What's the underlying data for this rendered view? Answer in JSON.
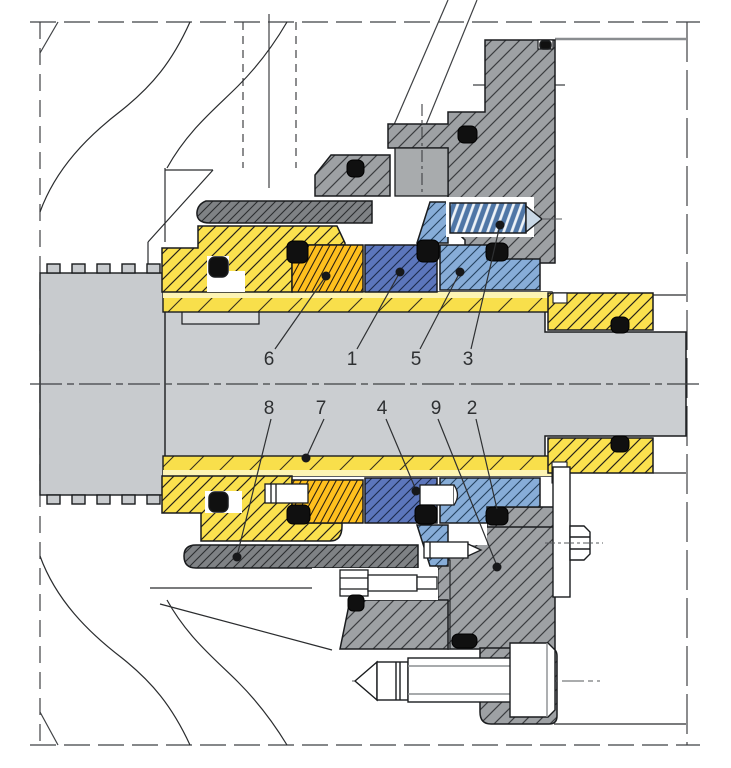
{
  "drawing": {
    "kind": "mechanical-seal-cartridge-cross-section",
    "callouts": {
      "upper": [
        {
          "label": "6"
        },
        {
          "label": "1"
        },
        {
          "label": "5"
        },
        {
          "label": "3"
        }
      ],
      "lower": [
        {
          "label": "8"
        },
        {
          "label": "7"
        },
        {
          "label": "4"
        },
        {
          "label": "9"
        },
        {
          "label": "2"
        }
      ]
    },
    "palette": {
      "sleeve_yellow": "#FBE14E",
      "ring_orange": "#FFC01E",
      "seal_ring_dark_blue": "#5C76BC",
      "seat_light_blue": "#87ADD8",
      "spring_steel_blue": "#4F76A6",
      "gland_gray": "#9EA1A4",
      "collar_dark_gray": "#7F8285",
      "shaft_gray": "#CBCED1",
      "oring_black": "#101010",
      "line": "#1a1c1e"
    }
  }
}
